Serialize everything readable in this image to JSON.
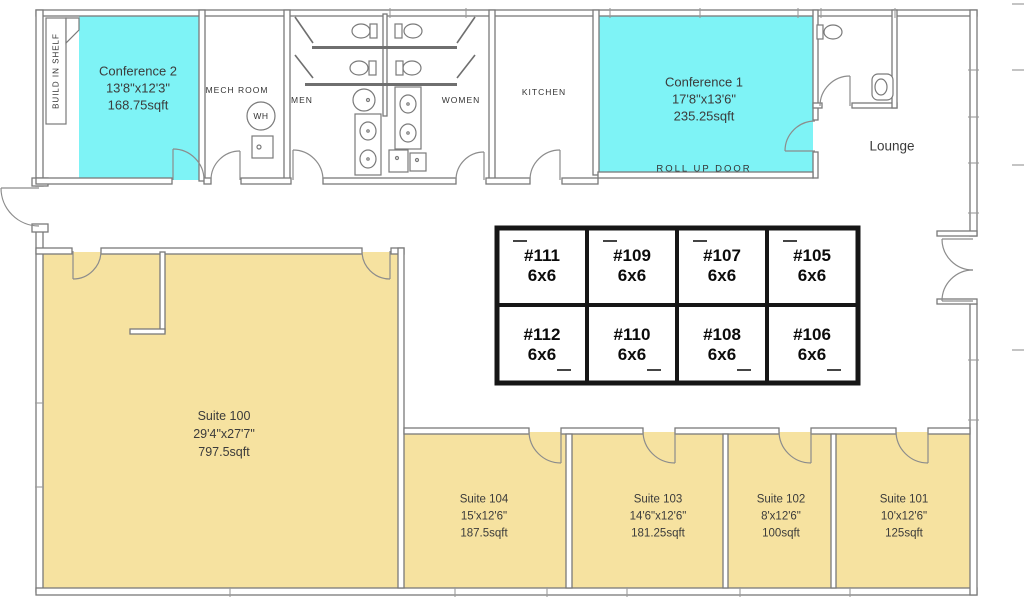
{
  "colors": {
    "conference_fill": "#7EF3F6",
    "suite_fill": "#F6E2A0",
    "wall": "#7a7a7a",
    "office_border": "#161616",
    "text": "#3b3b3b"
  },
  "rooms": {
    "build_in_shelf": {
      "label": "BUILD IN SHELF"
    },
    "conference2": {
      "name": "Conference 2",
      "dims": "13'8\"x12'3\"",
      "area": "168.75sqft"
    },
    "mech_room": {
      "label": "MECH ROOM",
      "water_heater": "WH"
    },
    "men": {
      "label": "MEN"
    },
    "women": {
      "label": "WOMEN"
    },
    "kitchen": {
      "label": "KITCHEN"
    },
    "conference1": {
      "name": "Conference 1",
      "dims": "17'8\"x13'6\"",
      "area": "235.25sqft",
      "roll_up_door": "ROLL UP DOOR"
    },
    "lounge": {
      "label": "Lounge"
    },
    "suite100": {
      "name": "Suite 100",
      "dims": "29'4\"x27'7\"",
      "area": "797.5sqft"
    },
    "suite104": {
      "name": "Suite 104",
      "dims": "15'x12'6\"",
      "area": "187.5sqft"
    },
    "suite103": {
      "name": "Suite 103",
      "dims": "14'6\"x12'6\"",
      "area": "181.25sqft"
    },
    "suite102": {
      "name": "Suite 102",
      "dims": "8'x12'6\"",
      "area": "100sqft"
    },
    "suite101": {
      "name": "Suite 101",
      "dims": "10'x12'6\"",
      "area": "125sqft"
    }
  },
  "offices": {
    "top_row": [
      {
        "number": "#111",
        "size": "6x6"
      },
      {
        "number": "#109",
        "size": "6x6"
      },
      {
        "number": "#107",
        "size": "6x6"
      },
      {
        "number": "#105",
        "size": "6x6"
      }
    ],
    "bottom_row": [
      {
        "number": "#112",
        "size": "6x6"
      },
      {
        "number": "#110",
        "size": "6x6"
      },
      {
        "number": "#108",
        "size": "6x6"
      },
      {
        "number": "#106",
        "size": "6x6"
      }
    ]
  }
}
